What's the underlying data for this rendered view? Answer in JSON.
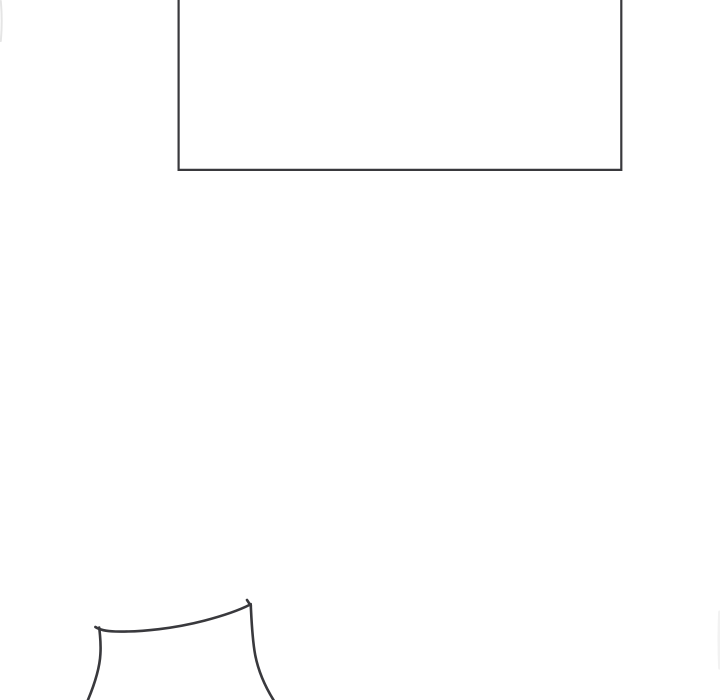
{
  "page": {
    "width_px": 720,
    "height_px": 700,
    "background_color": "#ffffff",
    "description": "Nearly blank comic/webtoon page region: an empty rectangular panel cropped by the top edge, a large white gutter, and a partial hand-drawn garment outline cropped by the bottom edge at lower left"
  },
  "artwork": {
    "ink_color": "#39393d",
    "panel": {
      "label": "empty-panel-cropped-at-top",
      "path": "M178.6,-2 L178.6,169.9 L621.3,169.9 L621.3,-2"
    },
    "left_edge_fragment": {
      "label": "faint-cropped-stroke-at-left-edge",
      "path": "M0.8,1 C1.9,13 1.9,29 0.8,41"
    },
    "right_edge_fragment": {
      "label": "ultra-faint-cropped-stroke-at-right-edge",
      "path": "M719.6,612 C718.8,630 718.8,650 719.6,668"
    },
    "figure": {
      "label": "hand-drawn-garment-top-cropped-at-bottom",
      "top_edge_path": "M95.4,627.0 C99.6,629.9 105.5,631.2 115.5,631.5 C142,632.1 175,628.3 204.5,620.6 C221.5,616.1 238.5,610.6 250.0,604.6",
      "left_side_path": "M99.2,627.6 C100.4,637.5 100.9,646.5 100.4,654.0 C99.8,666.5 95.3,682.5 87.6,700.8",
      "right_side_path": "M250.7,604.0 C251.5,619.5 252.1,638.5 255.2,655.0 C258.3,671.0 264.7,686.0 274.0,700.8",
      "peak_tick_path": "M250.8,605.8 L247.0,600.0"
    }
  }
}
